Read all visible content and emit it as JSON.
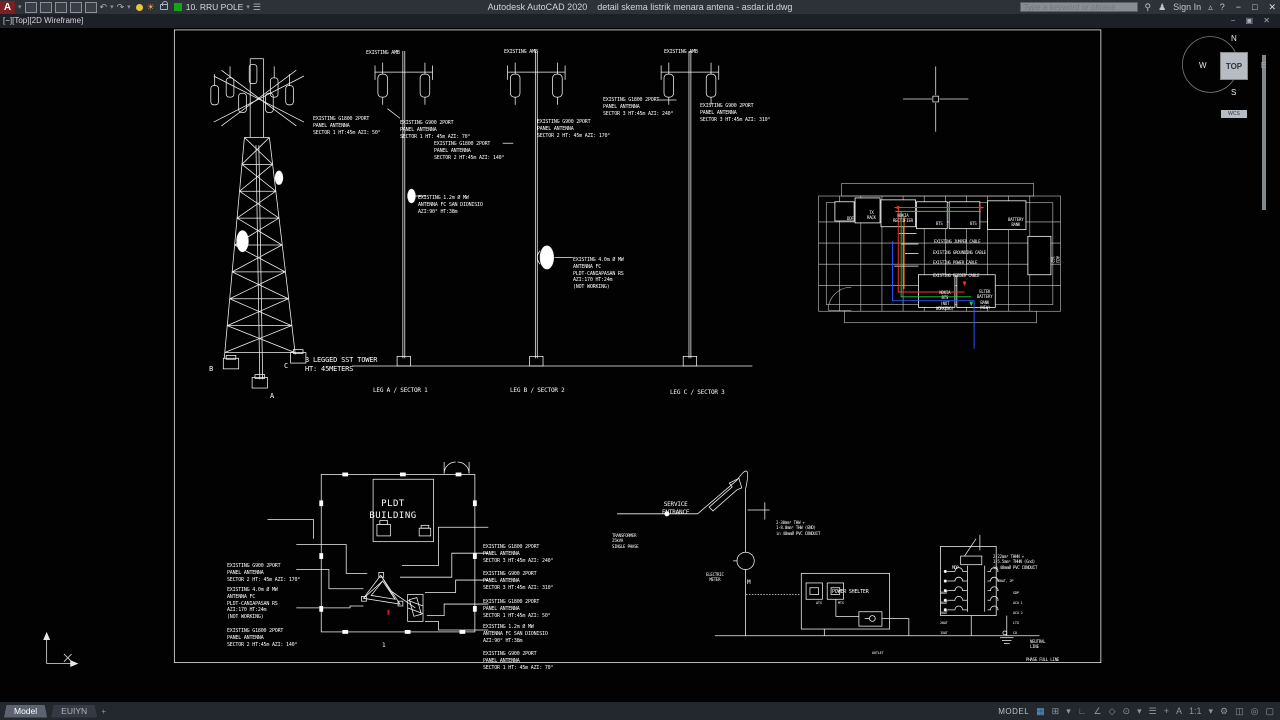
{
  "titlebar": {
    "logo": "A",
    "app_name": "Autodesk AutoCAD 2020",
    "doc_name": "detail skema listrik menara antena - asdar.id.dwg",
    "layer_value": "10. RRU POLE",
    "search_placeholder": "Type a keyword or phrase",
    "sign_in": "Sign In",
    "undo": "↶",
    "redo": "↷",
    "minimize": "−",
    "maximize": "□",
    "close": "✕"
  },
  "doc_controls": "− ▣ ✕",
  "viewport_label": "[−][Top][2D Wireframe]",
  "viewcube": {
    "north": "N",
    "south": "S",
    "east": "E",
    "west": "W",
    "face": "TOP",
    "wcs": "WCS"
  },
  "drawing": {
    "pole_header": "EXISTING AMB",
    "tower_g1800_s1": "EXISTING G1800 2PORT\nPANEL ANTENNA\nSECTOR 1 HT:45m AZI: 50°",
    "g900_s1": "EXISTING G900 2PORT\nPANEL ANTENNA\nSECTOR 1 HT: 45m AZI: 70°",
    "g1800_s2": "EXISTING G1800 2PORT\nPANEL ANTENNA\nSECTOR 2 HT:45m AZI: 140°",
    "mw_12": "EXISTING 1.2m Ø MW\nANTENNA FC SAN DIONISIO\nAZI:90° HT:38m",
    "g900_s2": "EXISTING G900 2PORT\nPANEL ANTENNA\nSECTOR 2 HT: 45m AZI: 170°",
    "g1800_s3": "EXISTING G1800 2PORT\nPANEL ANTENNA\nSECTOR 3 HT:45m AZI: 240°",
    "g900_s3": "EXISTING G900 2PORT\nPANEL ANTENNA\nSECTOR 3 HT:45m AZI: 310°",
    "mw_40": "EXISTING 4.0m Ø MW\nANTENNA FC\nPLDT-CANIAPASAN RS\nAZI:170 HT:24m\n(NOT WORKING)",
    "tower_title": "3 LEGGED SST TOWER\nHT: 45METERS",
    "leg_a": "LEG A / SECTOR 1",
    "leg_b": "LEG B / SECTOR 2",
    "leg_c": "LEG C / SECTOR 3",
    "foot_a": "A",
    "foot_b": "B",
    "foot_c": "C",
    "room": {
      "ddf": "DDF",
      "tx_rack": "TX\nRACK",
      "rectifier": "NOKIA\nRECTIFIER",
      "bts": "BTS",
      "battery_bank": "BATTERY\nBANK",
      "acu": "ACU\n1&2",
      "jumper": "EXISTING JUMPER CABLE",
      "grounding": "EXISTING GROUNDING CABLE",
      "power": "EXISTING POWER CABLE",
      "feeder": "EXISTING FEEDER CABLE",
      "nokia_bts": "NOKIA\nBTS\n(NOT\nWORKING)",
      "eltek": "ELTEK\nBATTERY\nBANK\n(NEW)",
      "cable_colors": {
        "jumper": "#ff2d2d",
        "grounding": "#22cc44",
        "power": "#ff8c00",
        "feeder": "#2b55ff"
      }
    },
    "building": {
      "name": "PLDT\nBUILDING",
      "marker": "1"
    },
    "schematic": {
      "service_entrance": "SERVICE\nENTRANCE",
      "spec_service": "2-30mm² THW +\n1-8.0mm² THW (GND)\nin 40mmØ PVC CONDUIT",
      "transformer": "TRANSFORMER\n25kVA\nSINGLE PHASE",
      "electric_meter": "ELECTRIC\nMETER",
      "meter_m": "M",
      "power_shelter": "POWER SHELTER",
      "ats": "ATS",
      "mts": "MTS",
      "outlet": "OUTLET",
      "spec_panel": "2-22mm² THHN +\n1-5.5mm² THHN (Gnd)\nin 40mmØ PVC CONDUIT",
      "mdp": "MDP",
      "main_breaker": "60AT, 2P",
      "breakers_left": [
        "30AT",
        "30AT",
        "20AT",
        "20AT",
        "15AT"
      ],
      "breakers_right": [
        "SDP",
        "ACU 1",
        "ACU 2",
        "LTG",
        "CO"
      ],
      "neutral": "NEUTRAL\nLINE",
      "phase": "PHASE FULL LINE"
    }
  },
  "statusbar": {
    "model_tab": "Model",
    "layout_tab": "EUIYN",
    "add_tab": "+",
    "model_label": "MODEL",
    "scale": "1:1",
    "annot": "A"
  }
}
